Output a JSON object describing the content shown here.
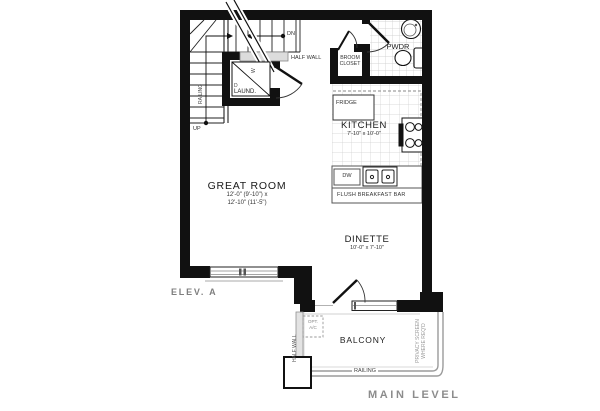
{
  "plan": {
    "title": "MAIN LEVEL",
    "elevation": "ELEV. A",
    "rooms": {
      "great_room": {
        "name": "GREAT ROOM",
        "dims1": "12'-0\" (9'-10\") x",
        "dims2": "12'-10\" (11'-5\")"
      },
      "kitchen": {
        "name": "KITCHEN",
        "dims": "7'-10\" x 10'-0\""
      },
      "dinette": {
        "name": "DINETTE",
        "dims": "10'-0\" x 7'-10\""
      },
      "pwdr": {
        "name": "PWDR"
      },
      "broom": {
        "line1": "BROOM",
        "line2": "CLOSET"
      },
      "laundry": {
        "name": "LAUND.",
        "washer": "W",
        "dryer": "D"
      },
      "balcony": {
        "name": "BALCONY"
      }
    },
    "labels": {
      "fridge": "FRIDGE",
      "dw": "DW",
      "flush_bar": "FLUSH BREAKFAST BAR",
      "half_wall_top": "HALF WALL",
      "half_wall_side": "HALF WALL",
      "railing_stairs": "RAILING",
      "railing_balcony": "RAILING",
      "privacy1": "PRIVACY SCREEN",
      "privacy2": "WHERE REQ'D",
      "opt_ac1": "OPT.",
      "opt_ac2": "A/C",
      "up": "UP",
      "dn": "DN"
    },
    "colors": {
      "wall": "#111111",
      "line": "#333333",
      "tile": "#c9c9c9",
      "railing": "#9b9b9b",
      "muted": "#8c8c8c"
    }
  }
}
